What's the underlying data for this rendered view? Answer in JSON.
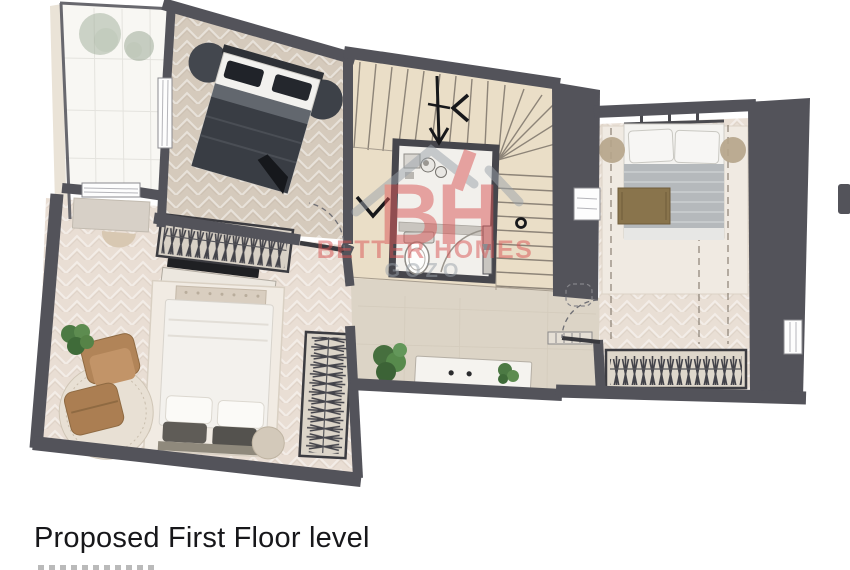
{
  "caption": {
    "title": "Proposed First Floor level",
    "second_line_cropped": true
  },
  "watermark": {
    "initials": "BH",
    "name": "BETTER HOMES",
    "region": "GOZO",
    "brand_red": "#d95454",
    "brand_gray": "#9aa2aa"
  },
  "palette": {
    "wall": "#53535a",
    "bedroom1_floor": "#d5cabc",
    "bedroom2_floor": "#e9ded4",
    "bedroom3_floor": "#e9dfd5",
    "hall_floor": "#dcd4c6",
    "stairs": "#eadec7",
    "terrace": "#f8f7f3",
    "bathroom": "#f2f0ec"
  },
  "plan": {
    "type": "residential-floor-plan",
    "rooms": [
      {
        "id": "terrace",
        "contents": [
          "two-shrubs"
        ]
      },
      {
        "id": "bedroom-top-left",
        "contents": [
          "double-bed-dark",
          "two-round-side-rugs",
          "window-to-terrace",
          "door-with-swing-arc"
        ]
      },
      {
        "id": "bedroom-bottom-left",
        "contents": [
          "double-bed-light",
          "armchair",
          "ottoman",
          "round-rug",
          "plant",
          "tv",
          "sideboard",
          "open-wardrobe-hangers-top",
          "open-wardrobe-hangers-right",
          "dresser",
          "two-round-stools"
        ]
      },
      {
        "id": "bedroom-right",
        "contents": [
          "double-bed-grey-blanket",
          "brown-throw",
          "two-round-side-rugs",
          "open-wardrobe-hangers",
          "plant",
          "window",
          "door-with-swing-arc",
          "dashed-ceiling-lines"
        ]
      },
      {
        "id": "bathroom-core",
        "contents": [
          "toilet",
          "vanity-sink",
          "counter",
          "door-with-swing-arc"
        ]
      },
      {
        "id": "staircase",
        "contents": [
          "u-shaped-stairs",
          "direction-arrows",
          "newel-ring"
        ]
      },
      {
        "id": "landing-hall",
        "contents": [
          "console-table",
          "two-plants"
        ]
      }
    ]
  }
}
